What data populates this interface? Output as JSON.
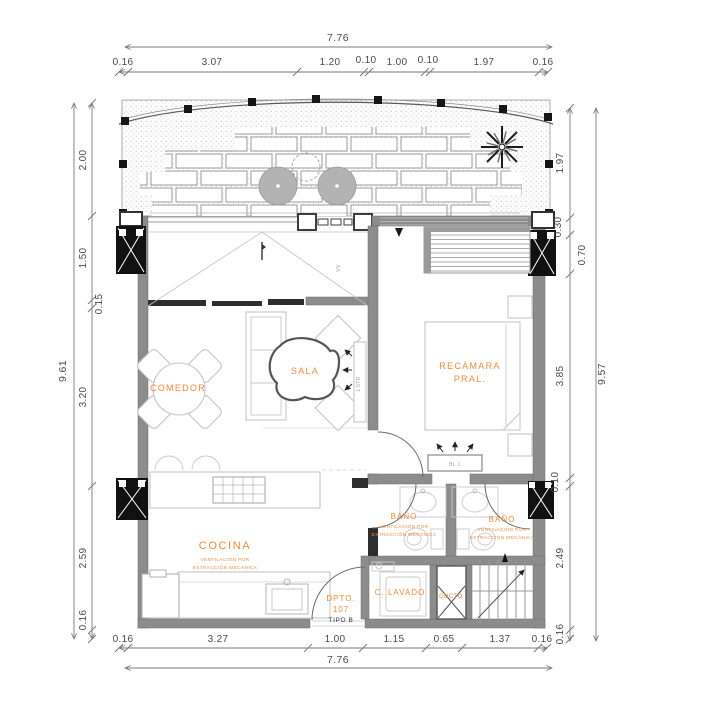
{
  "colors": {
    "accent": "#EF8A3C",
    "wall": "#8C8C8C",
    "furniture_line": "#C5C5C5",
    "dim_text": "#4A4A4A"
  },
  "dims": {
    "top_total": "7.76",
    "top_segments": [
      "0.16",
      "3.07",
      "1.20",
      "0.10",
      "1.00",
      "0.10",
      "1.97",
      "0.16"
    ],
    "bottom_segments": [
      "0.16",
      "3.27",
      "1.00",
      "1.15",
      "0.65",
      "1.37",
      "0.16"
    ],
    "bottom_total": "7.76",
    "left_total": "9.61",
    "left_segments": [
      "2.00",
      "1.50",
      "0.15",
      "3.20",
      "2.59",
      "0.16"
    ],
    "right_total": "9.57",
    "right_segments": [
      "1.97",
      "0.30",
      "0.70",
      "3.85",
      "0.10",
      "2.49",
      "0.16"
    ]
  },
  "rooms": {
    "comedor": "COMEDOR",
    "sala": "SALA",
    "recamara_line1": "RECÁMARA",
    "recamara_line2": "PRAL.",
    "cocina": "COCINA",
    "vent_line1": "VENTILACIÓN POR",
    "vent_line2": "EXTRACCIÓN MECÁNICA",
    "bano_left": "BAÑO",
    "bano_right": "BAÑO",
    "lavado": "C. LAVADO",
    "ducto": "DUCTO",
    "dpto_line1": "DPTO.",
    "dpto_line2": "107",
    "dpto_line3": "TIPO B"
  },
  "annotations": {
    "tv": "1.5TR",
    "window": "VV",
    "boiler": "BL 1"
  }
}
